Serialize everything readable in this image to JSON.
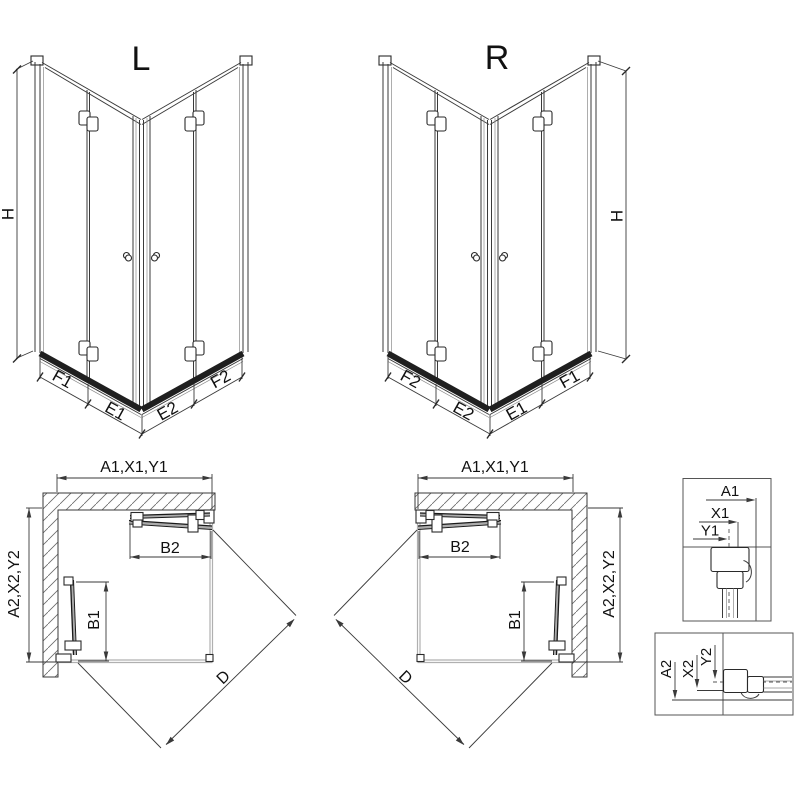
{
  "iso_left": {
    "title": "L",
    "height_label": "H",
    "bottom_labels": [
      "F1",
      "E1",
      "E2",
      "F2"
    ]
  },
  "iso_right": {
    "title": "R",
    "height_label": "H",
    "bottom_labels": [
      "F2",
      "E2",
      "E1",
      "F1"
    ]
  },
  "plan_left": {
    "width_label": "A1,X1,Y1",
    "depth_label": "A2,X2,Y2",
    "door_width_label": "B2",
    "door_depth_label": "B1",
    "diagonal_label": "D"
  },
  "plan_right": {
    "width_label": "A1,X1,Y1",
    "depth_label": "A2,X2,Y2",
    "door_width_label": "B2",
    "door_depth_label": "B1",
    "diagonal_label": "D"
  },
  "detail_top": {
    "labels": [
      "A1",
      "X1",
      "Y1"
    ]
  },
  "detail_bottom": {
    "labels": [
      "A2",
      "X2",
      "Y2"
    ]
  },
  "colors": {
    "line": "#3a3a3a",
    "dark_rail": "#1f1f1f",
    "tray": "#b0b0b0",
    "hatch": "#6a6a6a",
    "text": "#111111",
    "background": "#ffffff"
  }
}
